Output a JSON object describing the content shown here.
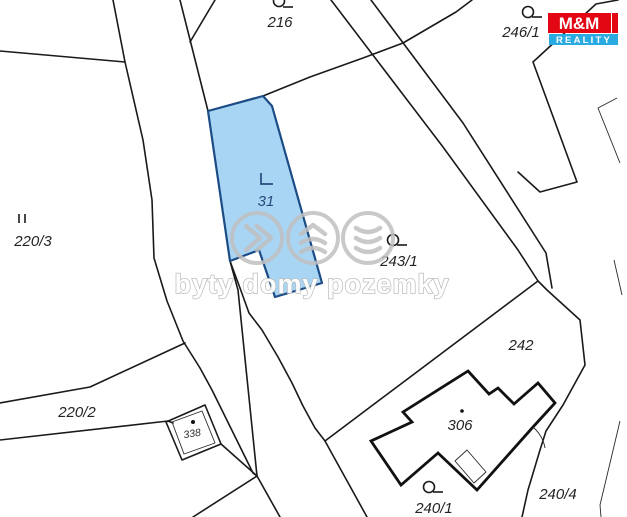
{
  "map": {
    "background": "#ffffff",
    "boundary_color": "#1a1a1a",
    "highlight_parcel": {
      "label": "31",
      "fill": "#a9d5f4",
      "stroke": "#1b4c85"
    },
    "parcels": {
      "p216": "216",
      "p246_1": "246/1",
      "p220_3": "220/3",
      "p31": "31",
      "p243_1": "243/1",
      "p242": "242",
      "p220_2": "220/2",
      "p338": "338",
      "p306": "306",
      "p240_1": "240/1",
      "p240_4": "240/4"
    },
    "symbols": [
      "parcel-point-icon",
      "land-use-corner-icon",
      "double-tick-icon",
      "center-dot-icon"
    ]
  },
  "watermark": {
    "text": "byty domy pozemky",
    "color": "#bfbfbf",
    "icons": [
      "chevrons-right-icon",
      "layers-up-icon",
      "layers-down-icon"
    ]
  },
  "logo": {
    "top": "M&M",
    "bottom": "REALITY",
    "red": "#e30613",
    "blue": "#29abe2"
  }
}
